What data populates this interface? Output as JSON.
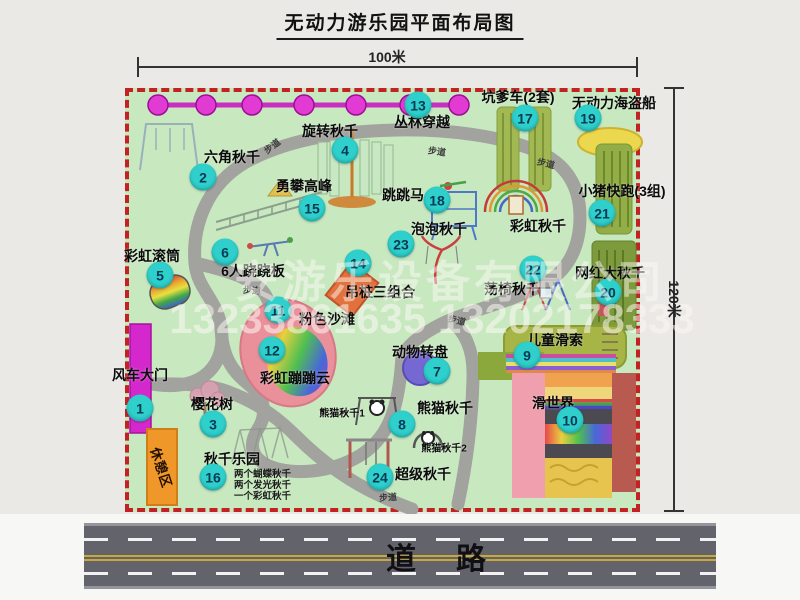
{
  "title": "无动力游乐园平面布局图",
  "dimensions": {
    "width": "100米",
    "height": "120米"
  },
  "road_label": "道路",
  "path_label": "步道",
  "rest_area_label": "休憩区",
  "watermark": {
    "company": "安游乐设备有限公司",
    "phones": "13233861635 13202178333"
  },
  "attractions": [
    {
      "num": "1",
      "label": "风车大门"
    },
    {
      "num": "2",
      "label": "六角秋千"
    },
    {
      "num": "3",
      "label": "樱花树"
    },
    {
      "num": "4",
      "label": "旋转秋千"
    },
    {
      "num": "5",
      "label": "彩虹滚筒"
    },
    {
      "num": "6",
      "label": "6人跷跷板"
    },
    {
      "num": "7",
      "label": "动物转盘"
    },
    {
      "num": "8",
      "label": "熊猫秋千"
    },
    {
      "num": "9",
      "label": "儿童滑索"
    },
    {
      "num": "10",
      "label": "滑世界"
    },
    {
      "num": "11",
      "label": "粉色沙滩"
    },
    {
      "num": "12",
      "label": "彩虹蹦蹦云"
    },
    {
      "num": "13",
      "label": "丛林穿越"
    },
    {
      "num": "14",
      "label": "吊桩三组合"
    },
    {
      "num": "15",
      "label": "勇攀高峰"
    },
    {
      "num": "16",
      "label": "秋千乐园"
    },
    {
      "num": "17",
      "label": "坑爹车(2套)"
    },
    {
      "num": "18",
      "label": "跳跳马"
    },
    {
      "num": "19",
      "label": "无动力海盗船"
    },
    {
      "num": "20",
      "label": "网红大秋千"
    },
    {
      "num": "21",
      "label": "小猪快跑(3组)"
    },
    {
      "num": "22",
      "label": "荡椅秋千"
    },
    {
      "num": "23",
      "label": "泡泡秋千"
    },
    {
      "num": "24",
      "label": "超级秋千"
    }
  ],
  "unnumbered_labels": {
    "rainbow_swing": "彩虹秋千",
    "panda_swing_1": "熊猫秋千1",
    "panda_swing_2": "熊猫秋千2"
  },
  "swing_park_notes": [
    "两个蝴蝶秋千",
    "两个发光秋千",
    "一个彩虹秋千"
  ],
  "colors": {
    "park_green": "#c8e8c0",
    "border_red": "#c32222",
    "badge_cyan": "#2fd0cc",
    "gate_magenta": "#d428cc",
    "rest_orange": "#ef9729",
    "road_grey": "#63636b",
    "zipline_magenta": "#e23bd4"
  }
}
